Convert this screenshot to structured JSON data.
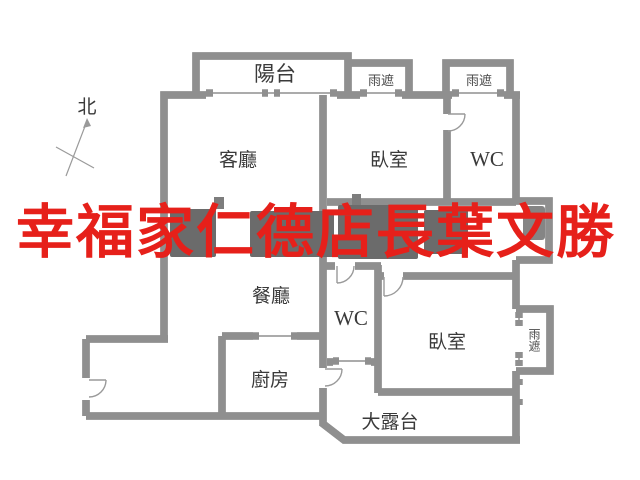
{
  "plan": {
    "background": "#ffffff",
    "wall_edge_color": "#8f8f8f",
    "wall_fill_color": "#b3b3b3",
    "thin_line_color": "#9a9a9a",
    "label_color": "#3a3a3a",
    "fixture_color": "#6b6b6b"
  },
  "compass": {
    "label": "北"
  },
  "rooms": [
    {
      "name": "balcony",
      "label": "陽台"
    },
    {
      "name": "living-room",
      "label": "客廳"
    },
    {
      "name": "bedroom-north",
      "label": "臥室"
    },
    {
      "name": "wc-north",
      "label": "WC"
    },
    {
      "name": "dining-room",
      "label": "餐廳"
    },
    {
      "name": "kitchen",
      "label": "廚房"
    },
    {
      "name": "wc-south",
      "label": "WC"
    },
    {
      "name": "bedroom-south",
      "label": "臥室"
    },
    {
      "name": "terrace",
      "label": "大露台"
    }
  ],
  "canopies": [
    {
      "name": "rain-canopy-north-1",
      "label": "雨遮"
    },
    {
      "name": "rain-canopy-north-2",
      "label": "雨遮"
    },
    {
      "name": "rain-canopy-east",
      "label": "雨遮"
    }
  ],
  "watermark": {
    "text": "幸福家仁德店長葉文勝",
    "color": "#e6201a"
  }
}
